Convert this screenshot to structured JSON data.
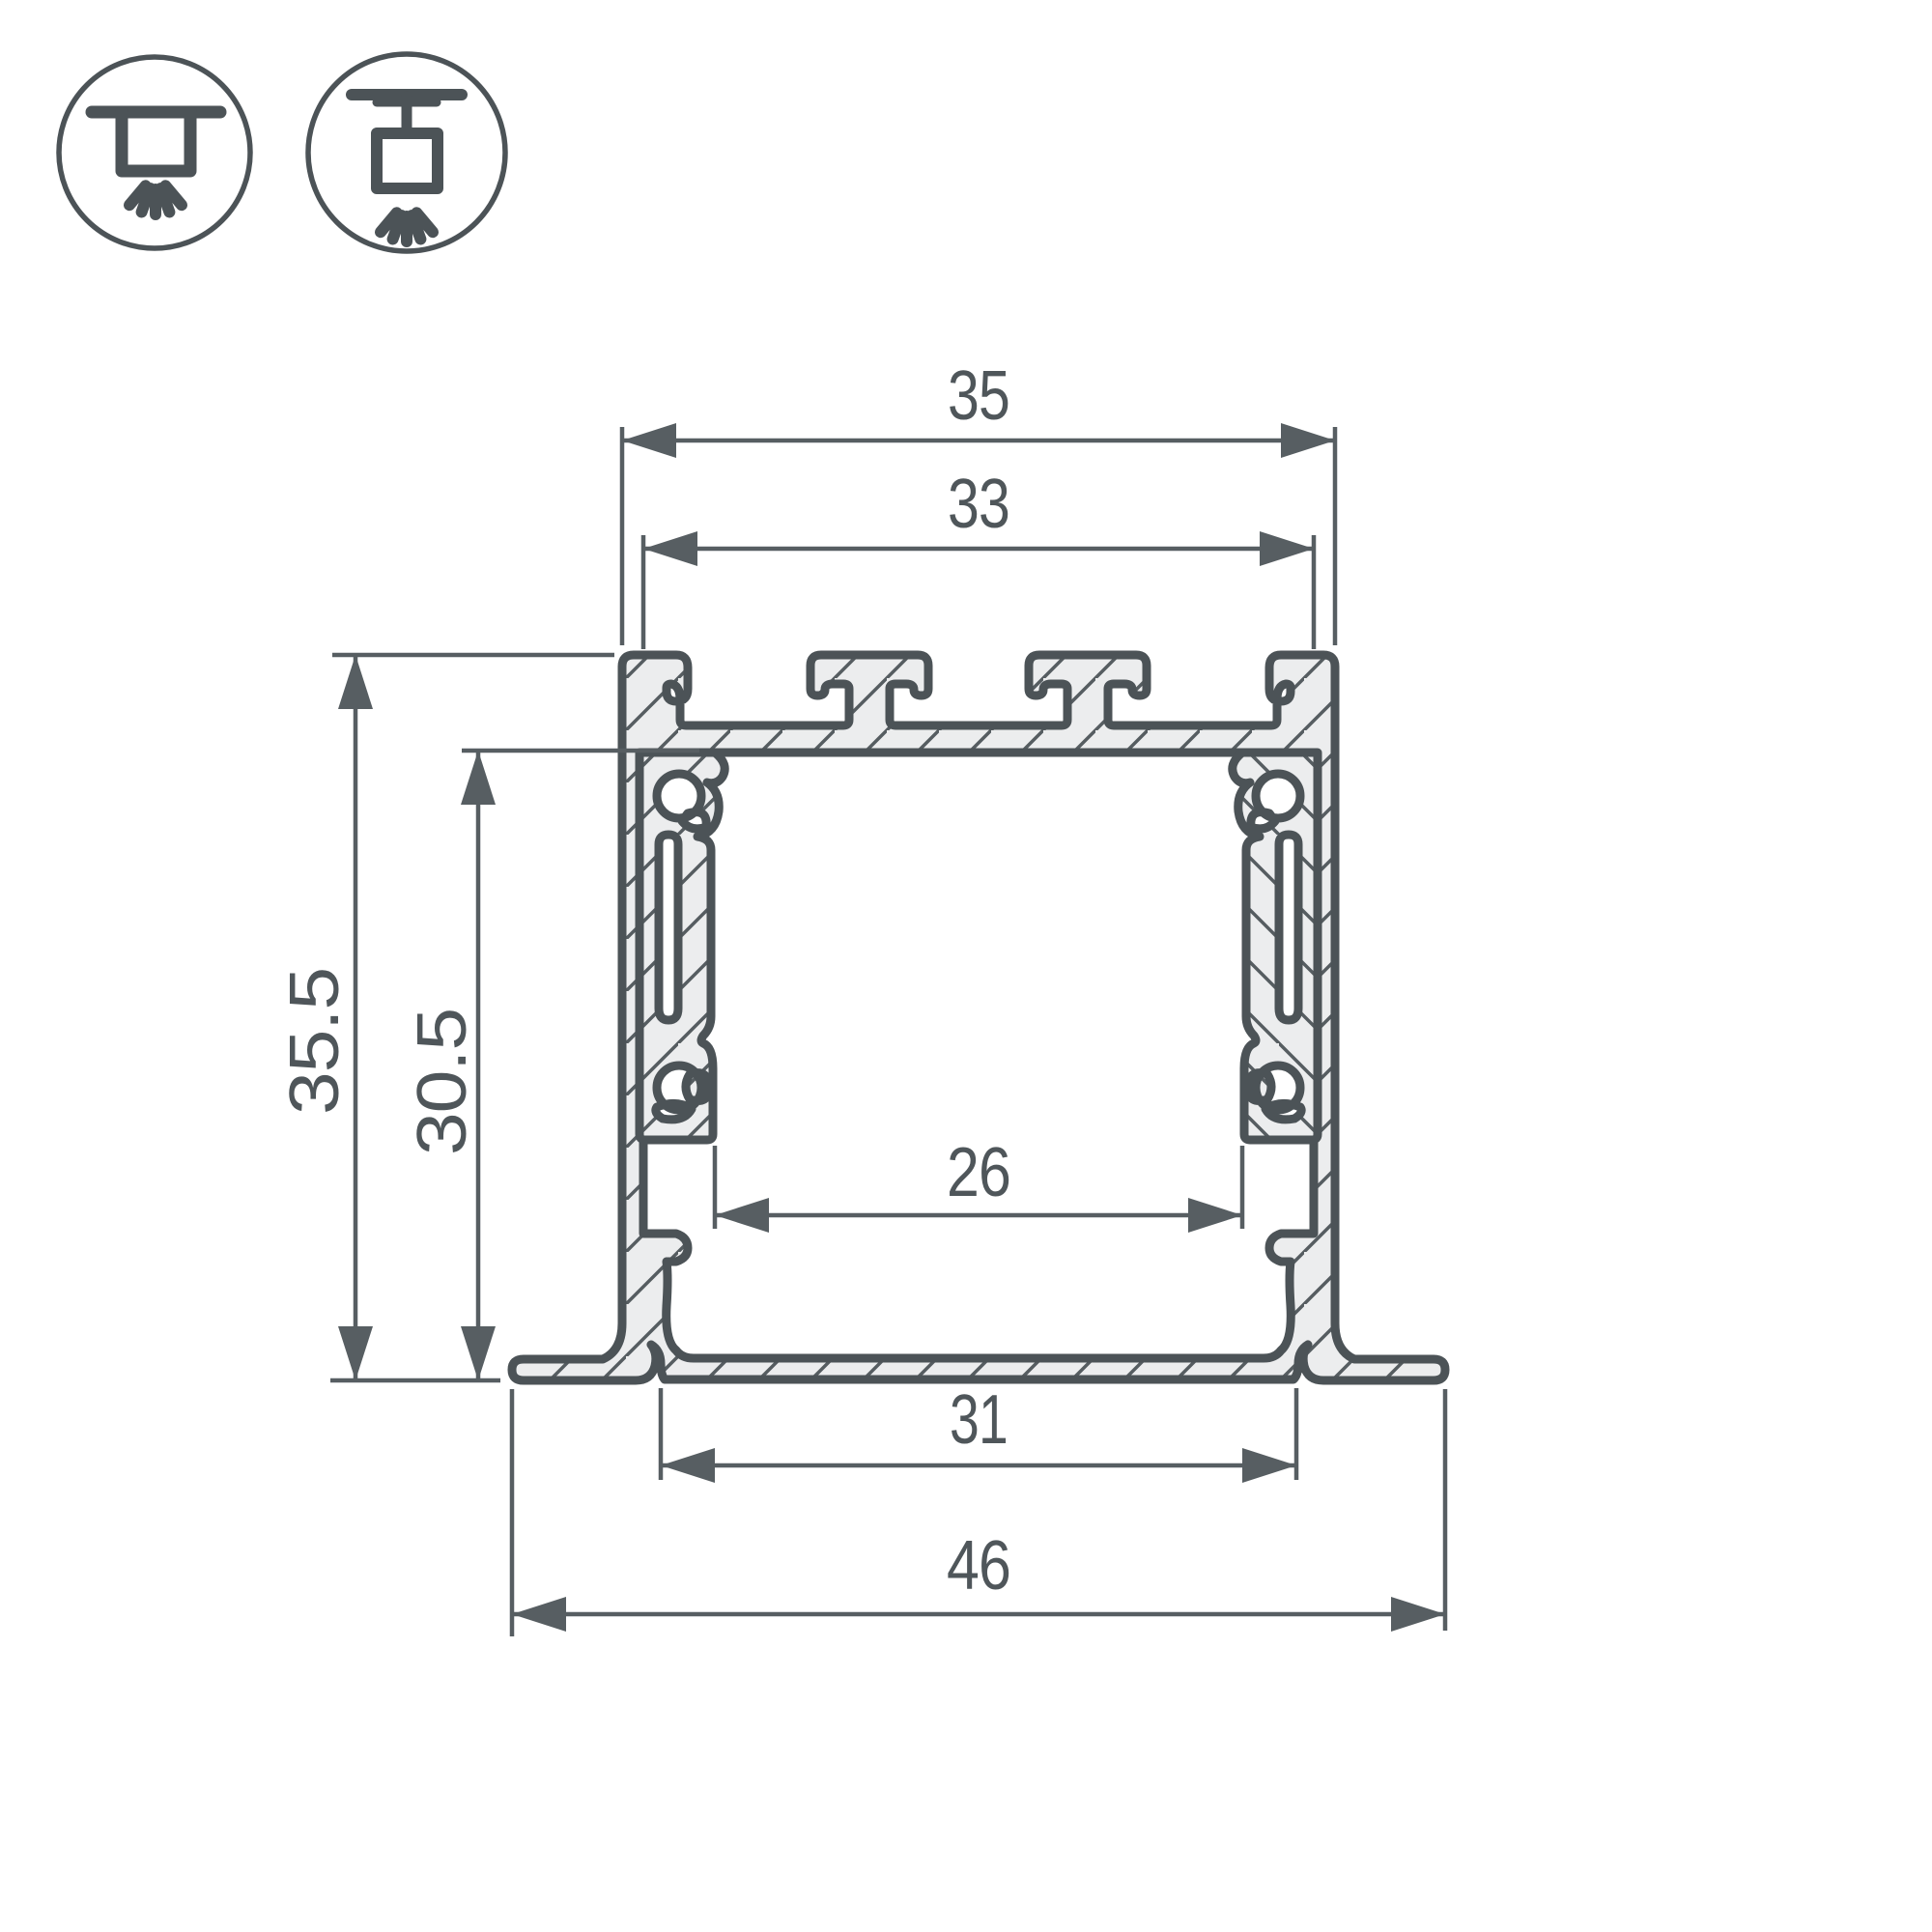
{
  "drawing": {
    "title": "led-profile-cross-section-dimension-drawing",
    "dims": {
      "top_width": "35",
      "top_inner_width": "33",
      "outer_height": "35.5",
      "inner_height": "30.5",
      "channel_width": "26",
      "opening_width": "31",
      "overall_width": "46"
    },
    "icons": [
      {
        "name": "recessed-mount-icon"
      },
      {
        "name": "surface-track-mount-icon"
      }
    ],
    "colors": {
      "outline": "#4C5357",
      "metal_fill": "#ECEDEE",
      "dimension_lines": "#575E62",
      "text": "#4F565A",
      "background": "#FFFFFF"
    }
  }
}
